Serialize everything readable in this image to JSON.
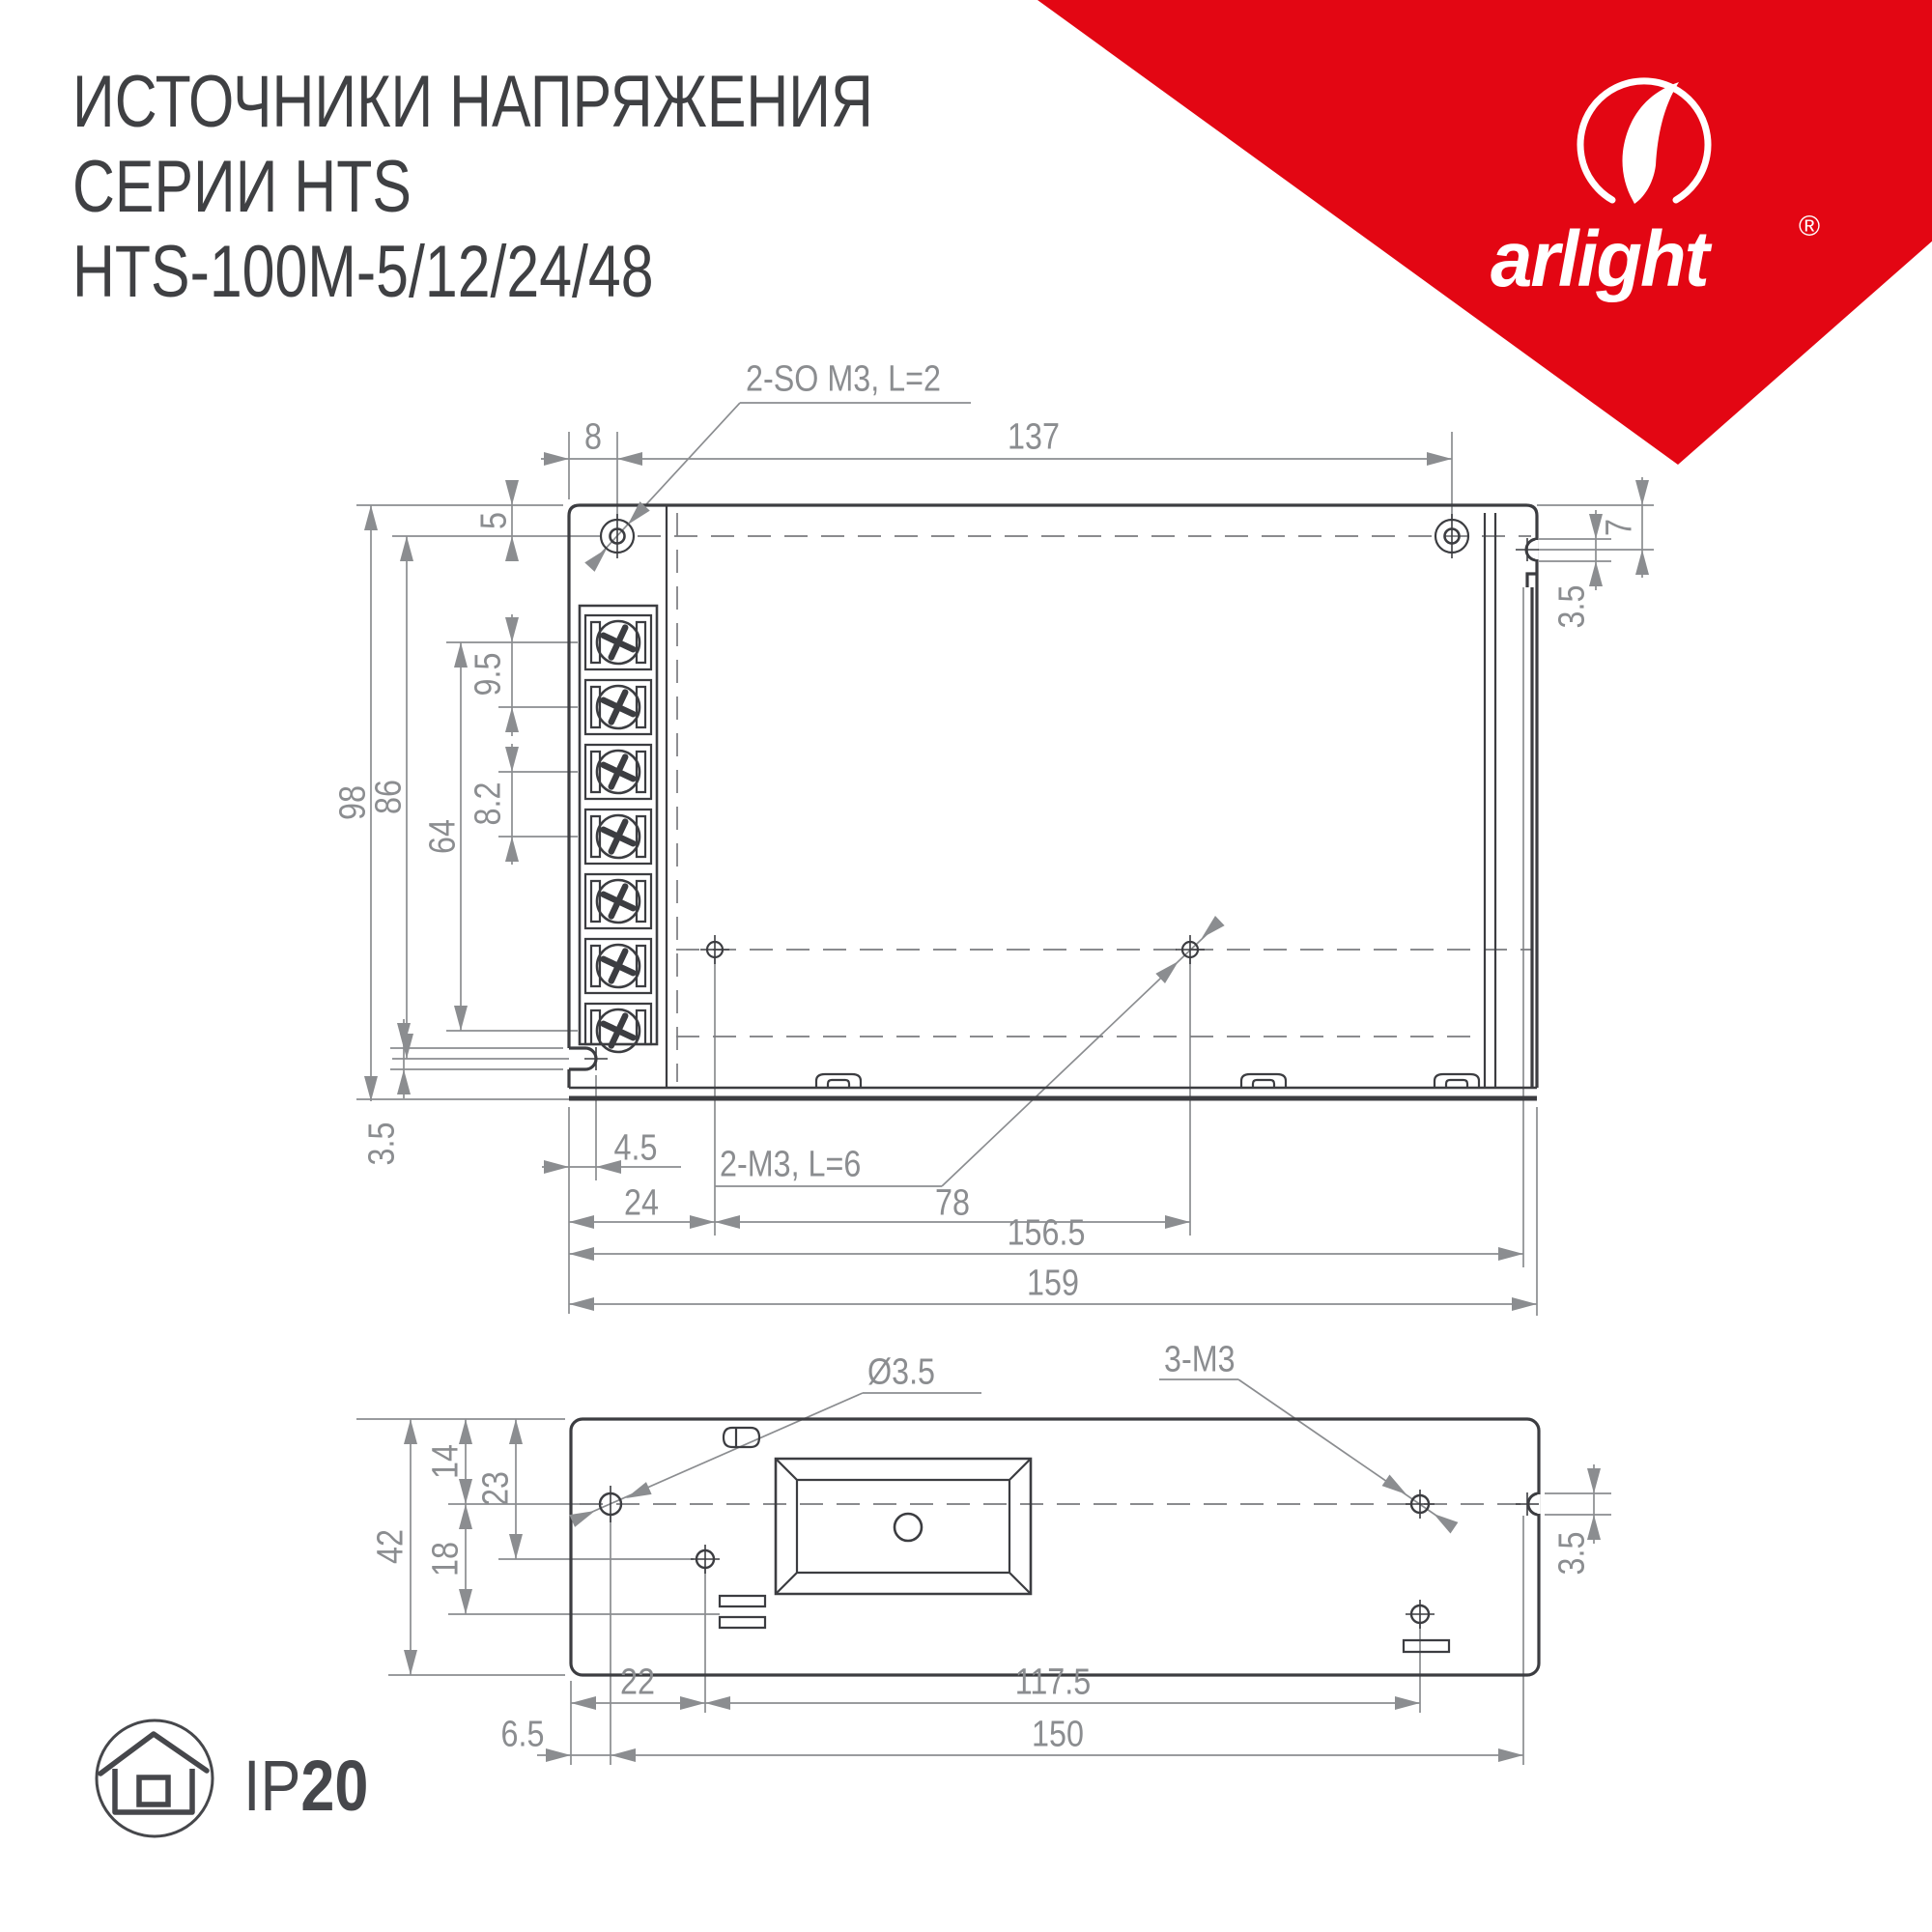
{
  "title": {
    "line1": "ИСТОЧНИКИ НАПРЯЖЕНИЯ",
    "line2": "СЕРИИ HTS",
    "line3": "HTS-100M-5/12/24/48"
  },
  "logo": {
    "brand": "arlight",
    "registered": "®"
  },
  "ip_rating": {
    "prefix": "IP",
    "value": "20"
  },
  "colors": {
    "brand_red": "#e30613",
    "line_dark": "#3c3d41",
    "dim_gray": "#8b8d90",
    "text_dark": "#3f4043"
  },
  "top_view": {
    "callout_top": "2-SO M3, L=2",
    "callout_bottom": "2-M3, L=6",
    "dims": {
      "hole_offset_x": "8",
      "hole_span": "137",
      "edge_to_centerline": "5",
      "screw_pitch_1": "9.5",
      "screw_pitch_2": "8.2",
      "terminal_span": "64",
      "centerline_span": "86",
      "height": "98",
      "right_top": "7",
      "right_slot": "3.5",
      "left_slot": "3.5",
      "slot_depth": "4.5",
      "hole1_x": "24",
      "hole_span_x": "78",
      "slot_center_x": "156.5",
      "width": "159"
    }
  },
  "bottom_view": {
    "callout_hole": "Ø3.5",
    "callout_thread": "3-M3",
    "dims": {
      "top_to_center": "14",
      "top_to_hole2": "23",
      "center_to_lower": "18",
      "height": "42",
      "right_slot": "3.5",
      "edge_to_hole2": "22",
      "hole_span": "117.5",
      "edge_to_hole1": "6.5",
      "mount_span": "150"
    }
  }
}
